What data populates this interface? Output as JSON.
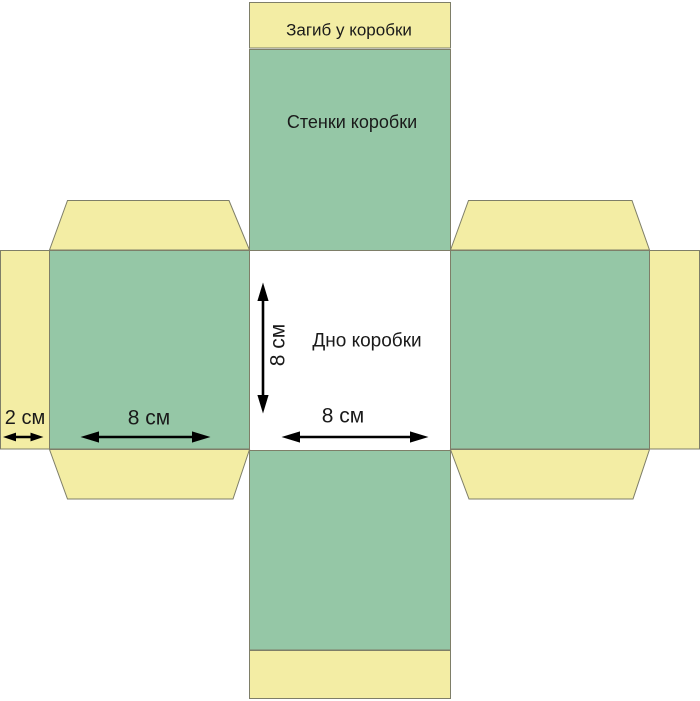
{
  "diagram": {
    "kind": "box-net-template",
    "colors": {
      "background": "#ffffff",
      "panel_green": "#95c7a6",
      "flap_yellow": "#f3eda4",
      "bottom_white": "#ffffff",
      "outline": "#7e7e68",
      "arrow": "#000000",
      "text": "#1a1a1a"
    },
    "labels": {
      "top_flap": "Загиб у коробки",
      "walls": "Стенки коробки",
      "bottom": "Дно коробки"
    },
    "dimensions": {
      "bottom_height": "8 см",
      "bottom_width": "8 см",
      "side_panel_width": "8 см",
      "glue_flap_width": "2 см"
    }
  }
}
